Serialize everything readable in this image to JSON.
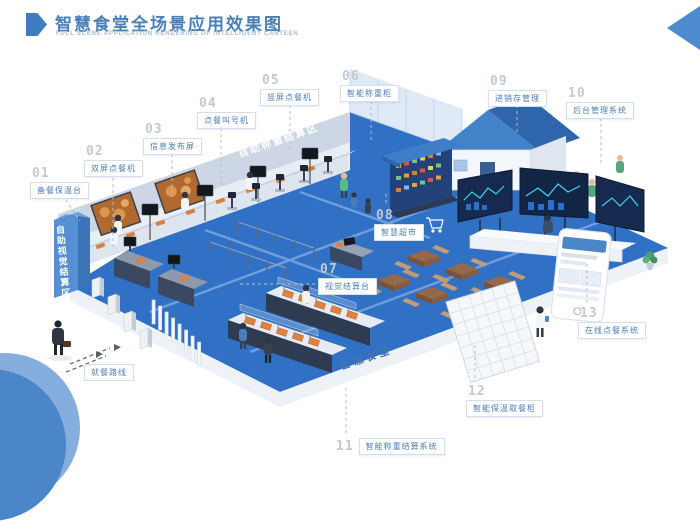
{
  "header": {
    "title": "智慧食堂全场景应用效果图",
    "subtitle": "FULL SCENE APPLICATION RENDERING OF INTELLIGENT CANTEEN"
  },
  "zones": {
    "weigh_area": "自助称重结算区",
    "vision_area": "自助视觉结算区",
    "canteen": "智慧食堂",
    "route": "就餐路线"
  },
  "callouts": [
    {
      "num": "01",
      "label": "备餐保温台"
    },
    {
      "num": "02",
      "label": "双屏点餐机"
    },
    {
      "num": "03",
      "label": "信息发布屏"
    },
    {
      "num": "04",
      "label": "点餐叫号机"
    },
    {
      "num": "05",
      "label": "竖屏点餐机"
    },
    {
      "num": "06",
      "label": "智能称重柜"
    },
    {
      "num": "07",
      "label": "视觉结算台"
    },
    {
      "num": "08",
      "label": "智慧超市"
    },
    {
      "num": "09",
      "label": "进销存管理"
    },
    {
      "num": "10",
      "label": "后台管理系统"
    },
    {
      "num": "11",
      "label": "智能称重结算系统"
    },
    {
      "num": "12",
      "label": "智能保温取餐柜"
    },
    {
      "num": "13",
      "label": "在线点餐系统"
    }
  ],
  "colors": {
    "accent": "#4a7fb5",
    "label_text": "#4a7db8",
    "floor_blue": "#3070c5",
    "roof_blue": "#4282c8",
    "screen_glow": "#3fd2f0",
    "tray_orange": "#df8140"
  }
}
